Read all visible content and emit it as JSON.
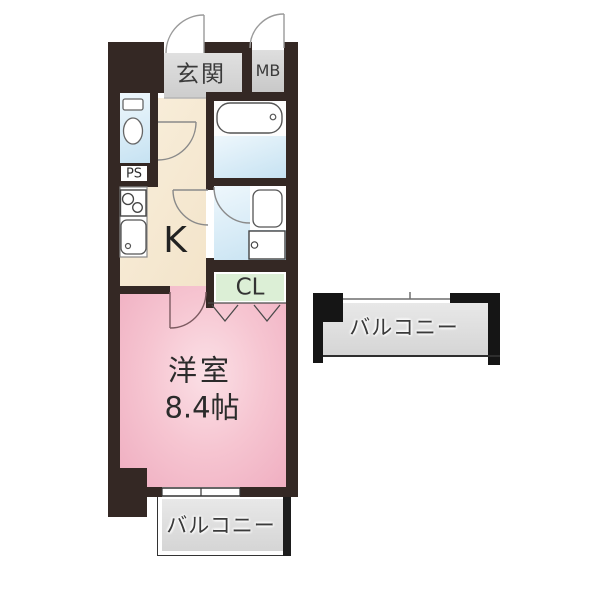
{
  "title": "apartment-floor-plan",
  "labels": {
    "entrance": "玄関",
    "meter_box": "MB",
    "pipe_space": "PS",
    "kitchen": "K",
    "closet": "CL",
    "room_name": "洋室",
    "room_size": "8.4帖",
    "balcony_right": "バルコニー",
    "balcony_bottom": "バルコニー"
  },
  "colors": {
    "wall": "#342824",
    "room_pink": "#f3b9c7",
    "kitchen_cream": "#f7ecd7",
    "wet_blue": "#cfe7f4",
    "closet_green": "#dcefd6",
    "entrance_gray": "#d8d8d8",
    "balcony_gray": "#dedede",
    "background": "#ffffff"
  }
}
